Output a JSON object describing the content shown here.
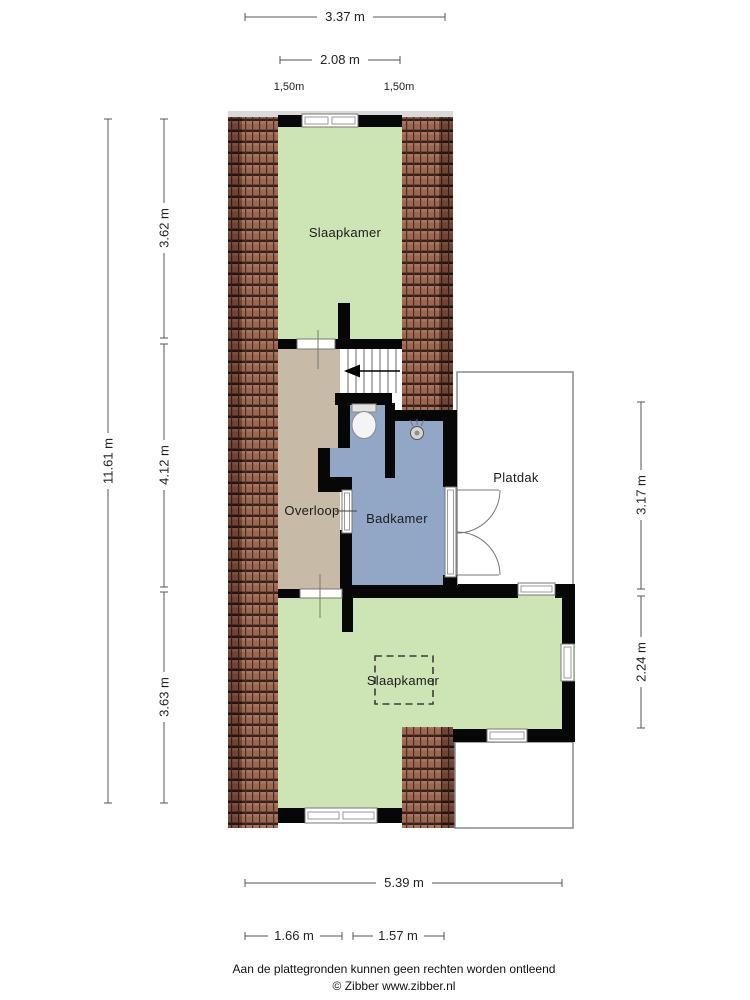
{
  "plan": {
    "rooms": {
      "bedroom_top": "Slaapkamer",
      "landing": "Overloop",
      "bathroom": "Badkamer",
      "flat_roof": "Platdak",
      "bedroom_bottom": "Slaapkamer"
    },
    "dimensions": {
      "top_width": "3.37 m",
      "top_inner_width": "2.08 m",
      "headroom_left": "1,50m",
      "headroom_right": "1,50m",
      "left_total": "11.61 m",
      "left_top": "3.62 m",
      "left_middle": "4.12 m",
      "left_bottom": "3.63 m",
      "right_top": "3.17 m",
      "right_bottom": "2.24 m",
      "bottom_total": "5.39 m",
      "bottom_left": "1.66 m",
      "bottom_right": "1.57 m"
    },
    "footer": {
      "disclaimer": "Aan de plattegronden kunnen geen rechten worden ontleend",
      "credit": "© Zibber www.zibber.nl"
    },
    "colors": {
      "room_green": "#cde4b5",
      "landing_tan": "#c7baa7",
      "bathroom_blue": "#92a7c5",
      "roof_tile": "#9c6750",
      "roof_tile_dark": "#6f4434",
      "wall_black": "#070707"
    }
  }
}
